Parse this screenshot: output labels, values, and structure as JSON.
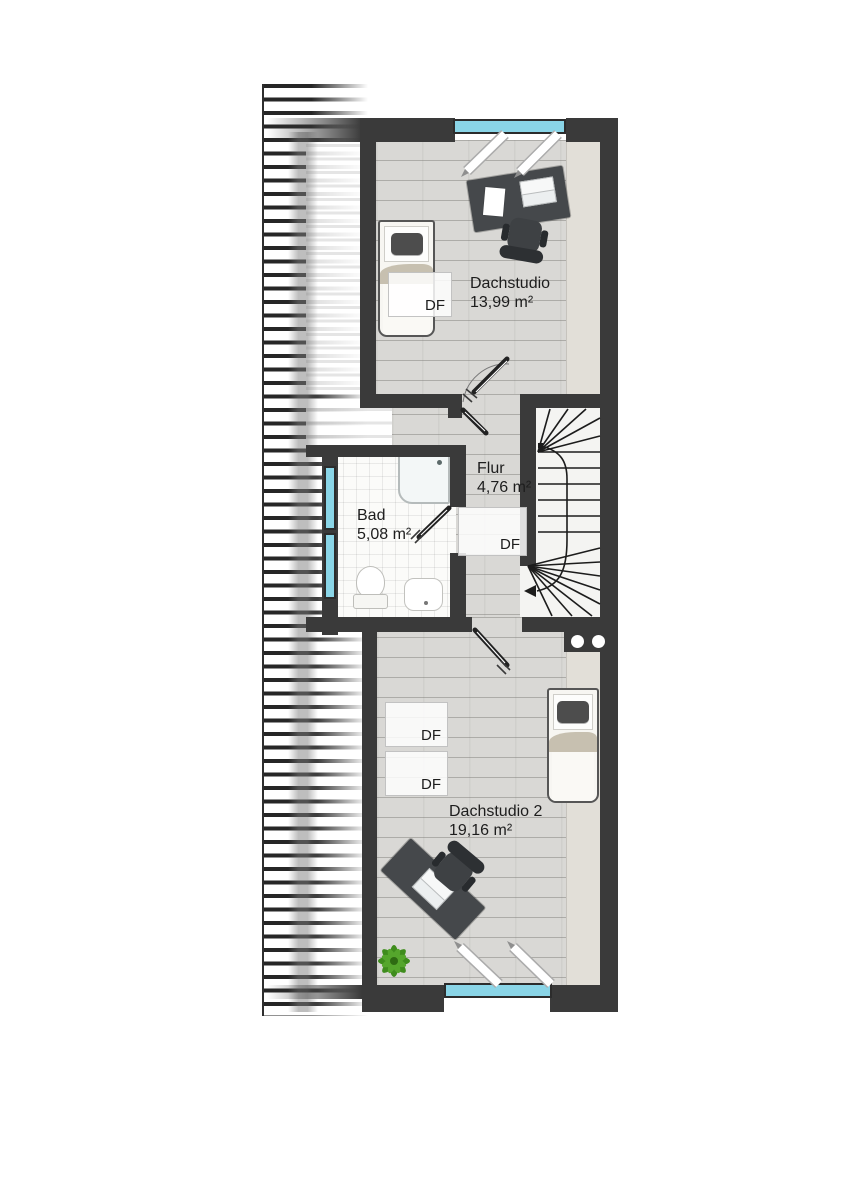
{
  "rooms": [
    {
      "name": "Dachstudio",
      "area": "13,99 m²"
    },
    {
      "name": "Flur",
      "area": "4,76 m²"
    },
    {
      "name": "Bad",
      "area": "5,08 m²"
    },
    {
      "name": "Dachstudio 2",
      "area": "19,16 m²"
    }
  ],
  "labels": {
    "roof_window": "DF"
  },
  "palette": {
    "wall": "#3a3a3a",
    "window": "#8ad5e7",
    "wood": "#d9d8d5",
    "tile": "#fbfbf9",
    "knee": "#e2dfd8",
    "hatch": "#262626",
    "stairbg": "#f4f4f2",
    "furn": "#45484b",
    "blanket": "#c7c0b0",
    "plant": "#3f8c1d",
    "label": "#1d1d1d",
    "line": "#1c1c1c"
  }
}
